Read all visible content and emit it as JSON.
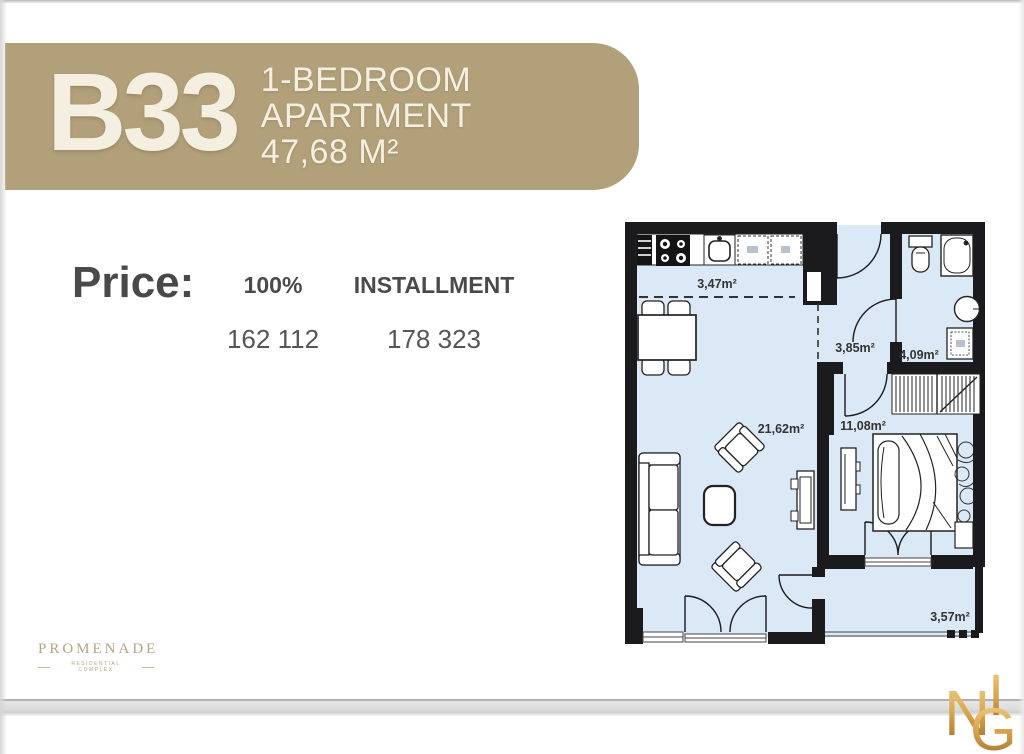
{
  "banner": {
    "unit": "B33",
    "lines": [
      "1-BEDROOM",
      "APARTMENT",
      "47,68 M²"
    ],
    "bg_color": "#b1a07a",
    "text_color": "#f4efe1"
  },
  "price": {
    "label": "Price:",
    "columns": [
      {
        "header": "100%",
        "value": "162 112"
      },
      {
        "header": "INSTALLMENT",
        "value": "178 323"
      }
    ]
  },
  "floorplan": {
    "wall_color": "#1b1b1d",
    "floor_color": "#dbe9f6",
    "rooms": [
      {
        "id": "kitchen-zone",
        "area_label": "3,47m²"
      },
      {
        "id": "hallway",
        "area_label": "3,85m²"
      },
      {
        "id": "bathroom",
        "area_label": "4,09m²"
      },
      {
        "id": "living-room",
        "area_label": "21,62m²"
      },
      {
        "id": "bedroom",
        "area_label": "11,08m²"
      },
      {
        "id": "balcony",
        "area_label": "3,57m²"
      }
    ]
  },
  "footer": {
    "brand": "PROMENADE",
    "brand_subtitle": "RESIDENTIAL COMPLEX",
    "brand_color": "#b5a57d",
    "monogram": {
      "letters": [
        "I",
        "N",
        "G"
      ],
      "gold_light": "#f2d389",
      "gold_dark": "#9a6a26"
    }
  }
}
